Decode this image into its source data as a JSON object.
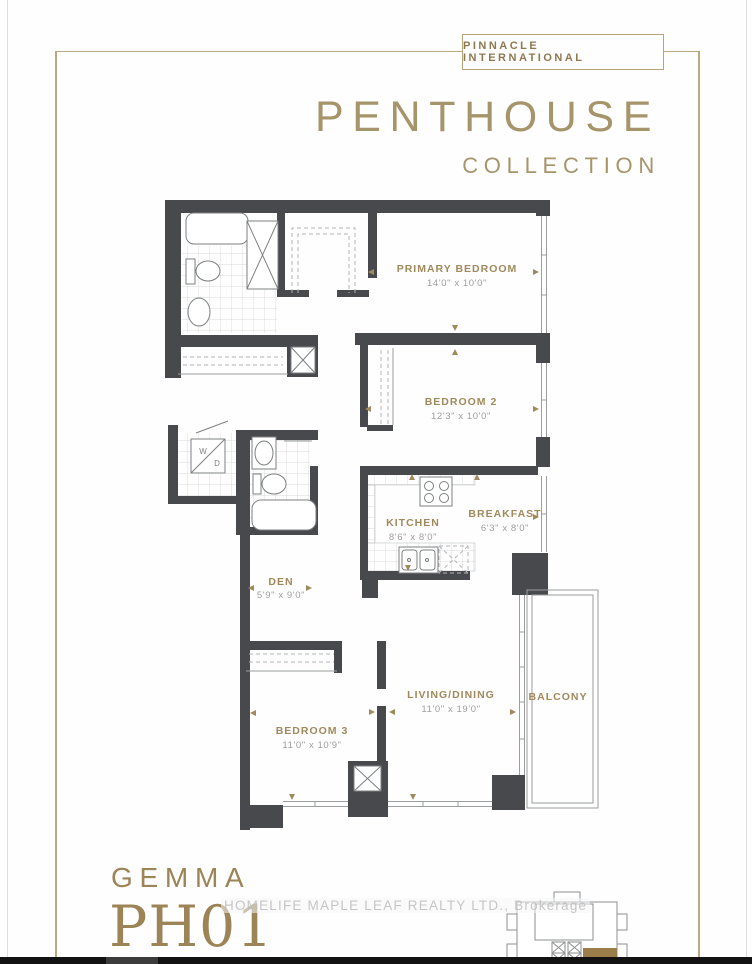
{
  "brand": {
    "box_label": "PINNACLE INTERNATIONAL",
    "title": "PENTHOUSE",
    "subtitle": "COLLECTION"
  },
  "rooms": [
    {
      "name": "PRIMARY BEDROOM",
      "dims": "14'0\" x 10'0\""
    },
    {
      "name": "BEDROOM 2",
      "dims": "12'3\" x 10'0\""
    },
    {
      "name": "KITCHEN",
      "dims": "8'6\" x 8'0\""
    },
    {
      "name": "BREAKFAST",
      "dims": "6'3\" x 8'0\""
    },
    {
      "name": "DEN",
      "dims": "5'9\" x 9'0\""
    },
    {
      "name": "LIVING/DINING",
      "dims": "11'0\" x 19'0\""
    },
    {
      "name": "BALCONY",
      "dims": ""
    },
    {
      "name": "BEDROOM 3",
      "dims": "11'0\" x 10'9\""
    }
  ],
  "labels": {
    "washer": "W",
    "dryer": "D"
  },
  "unit": {
    "model": "GEMMA",
    "number": "PH01"
  },
  "watermark": "HOMELIFE MAPLE LEAF REALTY LTD., Brokerage",
  "colors": {
    "accent_gold": "#a0895c",
    "frame_gold": "#b9a97e",
    "wall": "#47494c",
    "keyplan_unit_gold": "#9b7d4a"
  }
}
